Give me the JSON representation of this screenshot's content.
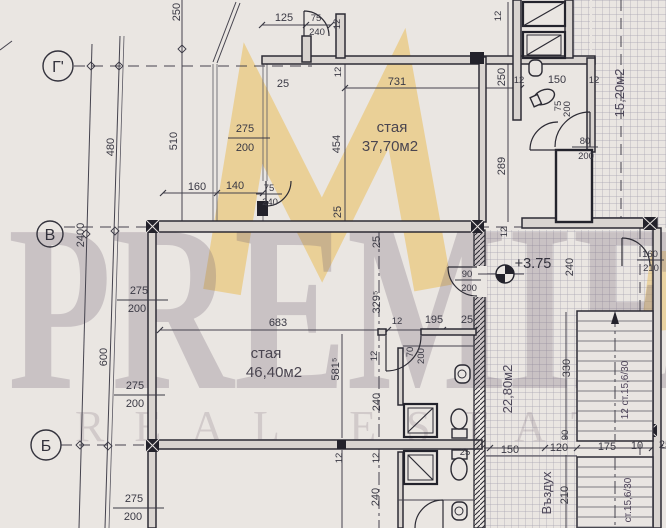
{
  "watermark": {
    "brand": "PREMIER",
    "tagline": "REAL ESTATE"
  },
  "colors": {
    "accent": "#e6b84c",
    "ink": "#33323c",
    "paper": "#eae6e2",
    "watermark_text": "#6c5c70"
  },
  "axes": {
    "g": "Г'",
    "v": "В",
    "b": "Б"
  },
  "rooms": {
    "room1": {
      "name": "стая",
      "area": "37,70м2"
    },
    "room2": {
      "name": "стая",
      "area": "46,40м2"
    },
    "corridor_area": "22,80м2",
    "hall_area": "15,20м2",
    "airshaft": "Въздух"
  },
  "level_mark": "+3.75",
  "stairs": {
    "upper": "12 ст.15,6/30",
    "lower": "ст.15,6/30"
  },
  "dims": {
    "a125": "125",
    "a75": "75",
    "a240": "240",
    "a25": "25",
    "a12a": "12",
    "a12b": "12",
    "a731": "731",
    "b250": "250",
    "b480": "480",
    "b510": "510",
    "b2400": "2400",
    "b600": "600",
    "b454": "454",
    "b25a": "25",
    "b25b": "25",
    "c275": "275",
    "c200": "200",
    "e160": "160",
    "e140": "140",
    "e75": "75",
    "e240": "240",
    "w275a": "275",
    "w200a": "200",
    "w275b": "275",
    "w200b": "200",
    "w275c": "275",
    "w200c": "200",
    "f683": "683",
    "f3295": "329⁵",
    "f5815": "581⁵",
    "f12a": "12",
    "f12b": "12",
    "f12c": "12",
    "f12d": "12",
    "f240a": "240",
    "f240b": "240",
    "f195": "195",
    "f25a": "25",
    "g12a": "12",
    "g150": "150",
    "g12b": "12",
    "g75": "75",
    "g200a": "200",
    "g80": "80",
    "g200b": "200",
    "g250": "250",
    "g289": "289",
    "g12c": "12",
    "g12d": "12",
    "h90": "90",
    "h200": "200",
    "i160": "160",
    "i210": "210",
    "i240": "240",
    "j25a": "25",
    "j150": "150",
    "j120": "120",
    "j175": "175",
    "j10": "10",
    "j25b": "25",
    "k330": "330",
    "k90": "90",
    "k210": "210",
    "m70": "70",
    "m200": "200"
  }
}
